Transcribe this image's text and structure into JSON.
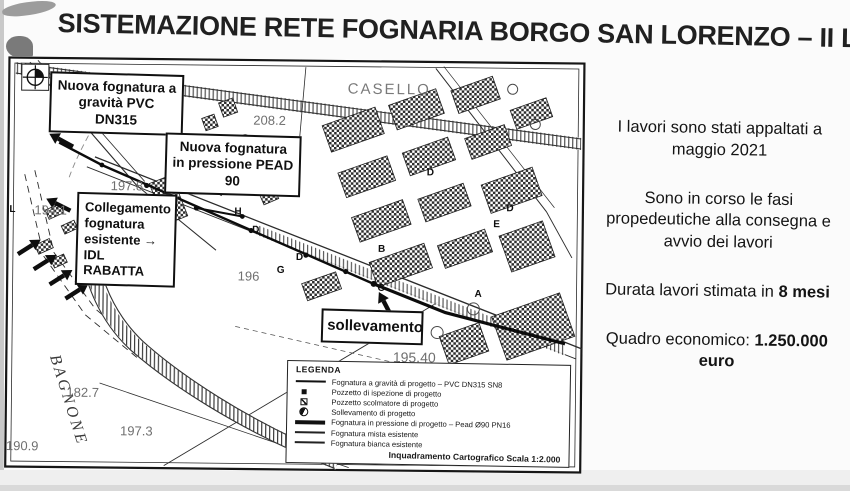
{
  "title": "SISTEMAZIONE RETE FOGNARIA BORGO SAN LORENZO – II LOTTO",
  "info_panel": {
    "p1": "I lavori sono stati appaltati a maggio 2021",
    "p2": "Sono in corso le fasi propedeutiche alla consegna e avvio dei lavori",
    "p3_prefix": "Durata lavori stimata in ",
    "p3_bold": "8 mesi",
    "p4_prefix": "Quadro economico: ",
    "p4_bold": "1.250.000 euro"
  },
  "map": {
    "callouts": {
      "gravita": "Nuova fognatura a gravità PVC DN315",
      "pressione": "Nuova fognatura in pressione PEAD 90",
      "collegamento": "Collegamento fognatura esistente → IDL RABATTA",
      "sollevamento": "sollevamento"
    },
    "labels": {
      "casello": "CASELLO",
      "bagnone": "BAGNONE",
      "road_number": "N.551",
      "elev_1": "208.2",
      "elev_2": "197.8",
      "elev_3": "194.1",
      "elev_4": "196",
      "elev_5": "195.40",
      "elev_6": "182.7",
      "elev_7": "197.3",
      "elev_8": "190.9"
    },
    "letters": [
      "L",
      "H",
      "D",
      "D",
      "G",
      "B",
      "C",
      "D",
      "D",
      "E",
      "A"
    ],
    "legend": {
      "title": "LEGENDA",
      "items": [
        {
          "label": "Fognatura a gravità di progetto – PVC DN315 SN8"
        },
        {
          "label": "Pozzetto di ispezione di progetto"
        },
        {
          "label": "Pozzetto scolmatore di progetto"
        },
        {
          "label": "Sollevamento di progetto"
        },
        {
          "label": "Fognatura in pressione di progetto – Pead Ø90 PN16"
        },
        {
          "label": "Fognatura mista esistente"
        },
        {
          "label": "Fognatura bianca esistente"
        }
      ],
      "scale_note": "Inquadramento Cartografico Scala 1:2.000"
    }
  }
}
